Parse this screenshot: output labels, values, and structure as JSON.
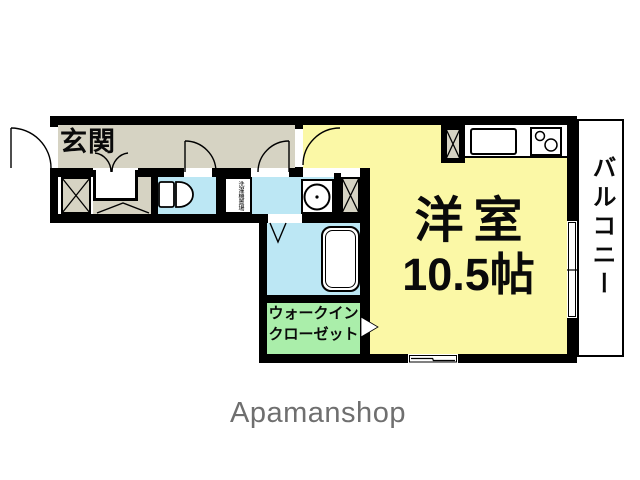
{
  "floorplan": {
    "rooms": {
      "genkan_label": "玄関",
      "room_label": "洋室",
      "room_size_label": "10.5帖",
      "balcony_label": "バルコニー",
      "wic_label_line1": "ウォークイン",
      "wic_label_line2": "クローゼット",
      "washer_label": "洗濯機置場"
    },
    "colors": {
      "room_yellow": "#fbf8a6",
      "hall_beige": "#d6d3c3",
      "water_blue": "#bce7f4",
      "closet_green": "#aaeeaa",
      "wall_black": "#000000"
    },
    "icons": [
      "entrance-door-arc",
      "closet-double-door-arc",
      "toilet-icon",
      "washbasin-icon",
      "bathtub-icon",
      "bath-door-icon",
      "kitchen-sink-icon",
      "stove-icon",
      "sliding-window-icon",
      "wic-entrance-arrow-icon",
      "storage-x-icon"
    ]
  },
  "footer": {
    "brand": "Apamanshop"
  }
}
